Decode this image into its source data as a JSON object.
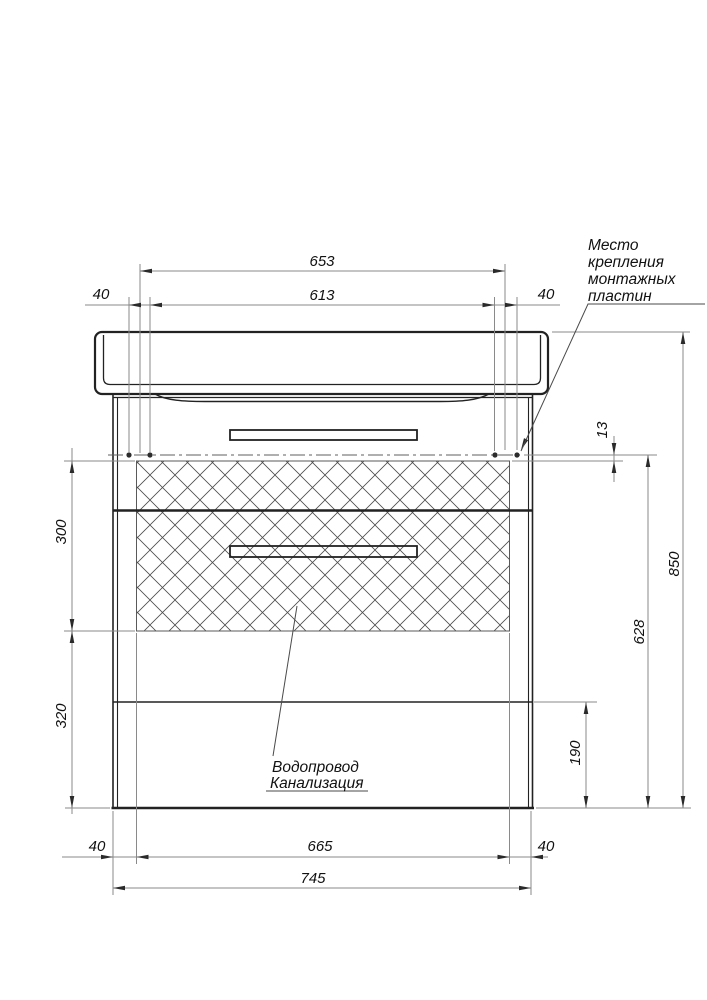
{
  "drawing": {
    "dimensions": {
      "top_span": "653",
      "top_inner_span": "613",
      "top_left_offset": "40",
      "top_right_offset": "40",
      "side_upper": "300",
      "side_lower": "320",
      "plate_offset": "13",
      "opening_height": "628",
      "total_height": "850",
      "lower_front_height": "190",
      "bottom_left_offset": "40",
      "opening_width": "665",
      "bottom_right_offset": "40",
      "total_width": "745"
    },
    "annotations": {
      "mounting_plates": [
        "Место",
        "крепления",
        "монтажных",
        "пластин"
      ],
      "plumbing": [
        "Водопровод",
        "Канализация"
      ]
    },
    "colors": {
      "object_line": "#222222",
      "dimension_line": "#8a8a8a",
      "text": "#111111",
      "background": "#ffffff"
    }
  }
}
